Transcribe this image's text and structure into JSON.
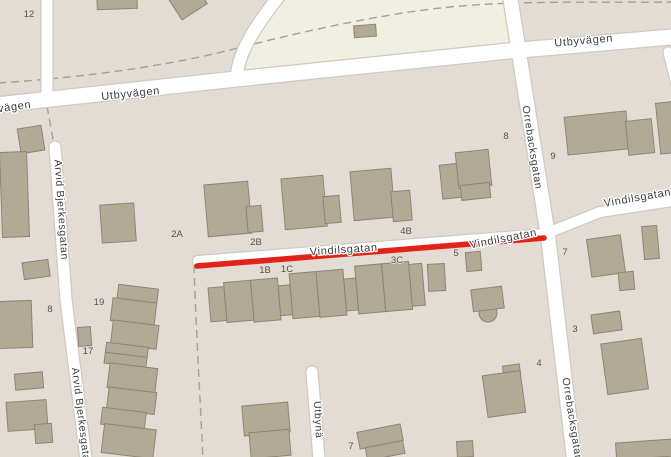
{
  "map": {
    "colors": {
      "land": "#e2dcd4",
      "open_area": "#f1efe2",
      "road_fill": "#ffffff",
      "road_casing": "#cfc9c0",
      "building_fill": "#b3aa96",
      "building_stroke": "#8e8573",
      "footpath_dash": "#a6a094",
      "route_highlight": "#e2231a",
      "street_label": "#3d3d3d",
      "house_number": "#575350"
    },
    "route": {
      "color": "#e2231a",
      "along_street": "Vindilsgatan"
    },
    "street_labels": [
      {
        "text": "vägen",
        "x": 15,
        "y": 110,
        "rot": -8,
        "size": "normal"
      },
      {
        "text": "Utbyvägen",
        "x": 131,
        "y": 97,
        "rot": -6,
        "size": "normal"
      },
      {
        "text": "Utbyvägen",
        "x": 584,
        "y": 44,
        "rot": -5,
        "size": "normal"
      },
      {
        "text": "Vindilsgatan",
        "x": 344,
        "y": 253,
        "rot": -4,
        "size": "normal"
      },
      {
        "text": "Vindilsgatan",
        "x": 504,
        "y": 242,
        "rot": -11,
        "size": "normal"
      },
      {
        "text": "Vindilsgatan",
        "x": 638,
        "y": 201,
        "rot": -10,
        "size": "normal"
      },
      {
        "text": "Orrebacksgatan",
        "x": 529,
        "y": 148,
        "rot": 81,
        "size": "small"
      },
      {
        "text": "Orrebacksgatan",
        "x": 569,
        "y": 420,
        "rot": 81,
        "size": "small"
      },
      {
        "text": "Arvid Bjerkesgatan",
        "x": 58,
        "y": 210,
        "rot": 86,
        "size": "small"
      },
      {
        "text": "Arvid Bjerkesgatan",
        "x": 78,
        "y": 418,
        "rot": 83,
        "size": "small"
      },
      {
        "text": "Utbynä",
        "x": 315,
        "y": 420,
        "rot": 87,
        "size": "small"
      }
    ],
    "house_numbers": [
      {
        "text": "12",
        "x": 29,
        "y": 17
      },
      {
        "text": "8",
        "x": 506,
        "y": 139
      },
      {
        "text": "9",
        "x": 553,
        "y": 159
      },
      {
        "text": "2A",
        "x": 177,
        "y": 237
      },
      {
        "text": "2B",
        "x": 256,
        "y": 245
      },
      {
        "text": "4B",
        "x": 406,
        "y": 234
      },
      {
        "text": "1B",
        "x": 265,
        "y": 273
      },
      {
        "text": "1C",
        "x": 287,
        "y": 272
      },
      {
        "text": "3C",
        "x": 397,
        "y": 263
      },
      {
        "text": "5",
        "x": 456,
        "y": 256
      },
      {
        "text": "7",
        "x": 565,
        "y": 255
      },
      {
        "text": "8",
        "x": 50,
        "y": 312
      },
      {
        "text": "19",
        "x": 99,
        "y": 305
      },
      {
        "text": "17",
        "x": 88,
        "y": 354
      },
      {
        "text": "4",
        "x": 539,
        "y": 366
      },
      {
        "text": "3",
        "x": 575,
        "y": 332
      },
      {
        "text": "7",
        "x": 351,
        "y": 449
      }
    ]
  }
}
